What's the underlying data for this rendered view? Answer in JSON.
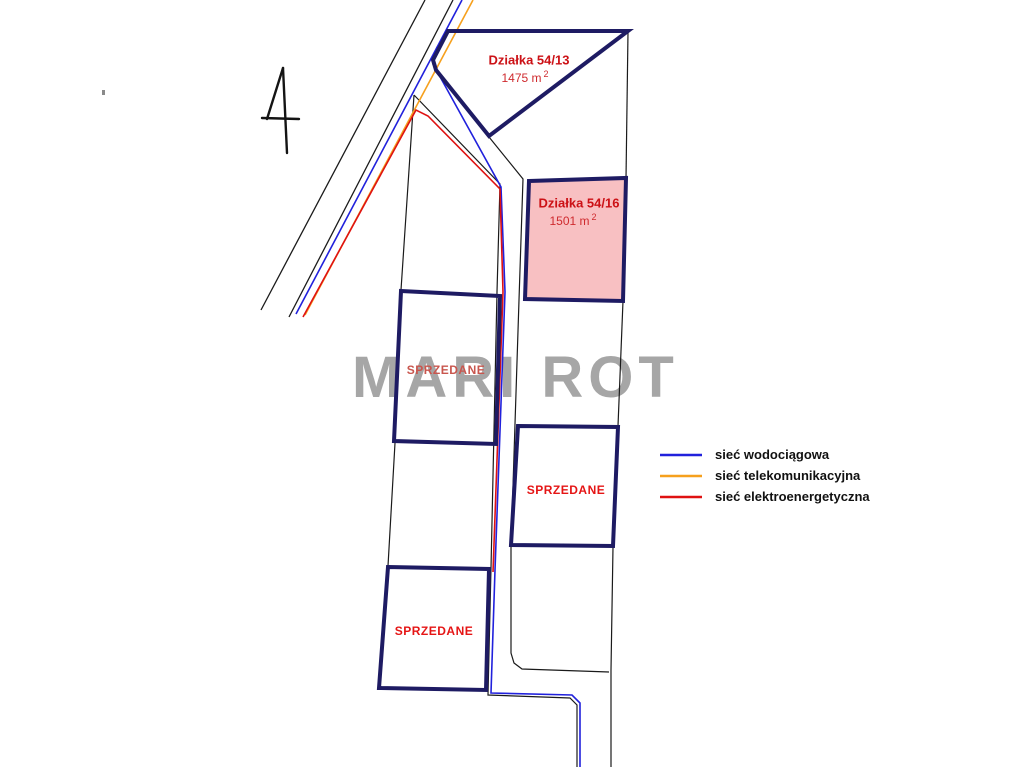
{
  "watermark": {
    "text": "MARI ROT"
  },
  "plots": {
    "p5413": {
      "title": "Działka 54/13",
      "area_value": "1475 m",
      "area_sup": "2"
    },
    "p5416": {
      "title": "Działka 54/16",
      "area_value": "1501 m",
      "area_sup": "2"
    },
    "sold_left_top": {
      "status": "SPRZEDANE"
    },
    "sold_left_bottom": {
      "status": "SPRZEDANE"
    },
    "sold_right": {
      "status": "SPRZEDANE"
    }
  },
  "legend": {
    "items": [
      {
        "label": "sieć wodociągowa",
        "color": "#2121dc"
      },
      {
        "label": "sieć telekomunikacyjna",
        "color": "#f6a01d"
      },
      {
        "label": "sieć elektroenergetyczna",
        "color": "#df1212"
      }
    ]
  },
  "colors": {
    "plot_border_navy": "#1e1b63",
    "plot_highlight_fill": "#f8c0c2",
    "label_red": "#cc1116",
    "sold_red": "#e51515",
    "watermark_gray": "#a6a6a6"
  },
  "icons": {
    "north_arrow": "north-arrow"
  }
}
